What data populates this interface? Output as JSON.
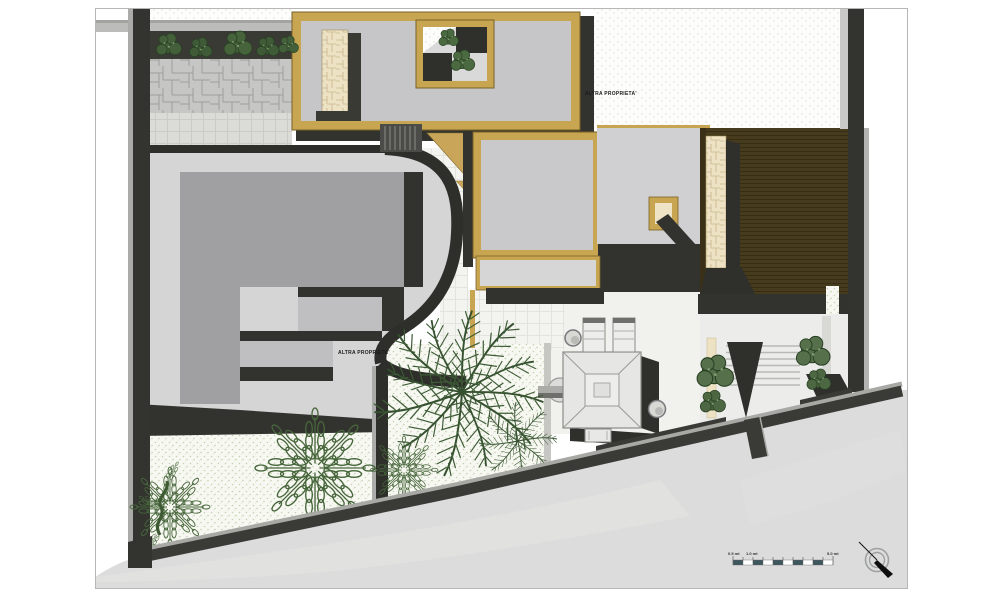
{
  "plan": {
    "annotations": {
      "other_property_top": "ALTRA PROPRIETA'",
      "other_property_left": "ALTRA PROPRIETA'"
    },
    "scale_bar": {
      "tick_labels": [
        "0.5 mt",
        "1.0 mt",
        "5.0 mt"
      ],
      "segment_count": 10,
      "segment_color": "#3E565E"
    },
    "icons": {
      "north_arrow": "north-arrow-icon"
    },
    "colors": {
      "wall_charcoal": "#33332F",
      "roof_gray": "#C7C7C9",
      "frame_tan": "#C8A551",
      "deck_brown": "#473B1E",
      "stone_cream": "#EDE2C4",
      "vegetation_green": "#3E5A33",
      "paving_light": "#F3F3F0",
      "street_gray": "#DCDCDC",
      "terrace_gray": "#A0A0A2"
    }
  }
}
